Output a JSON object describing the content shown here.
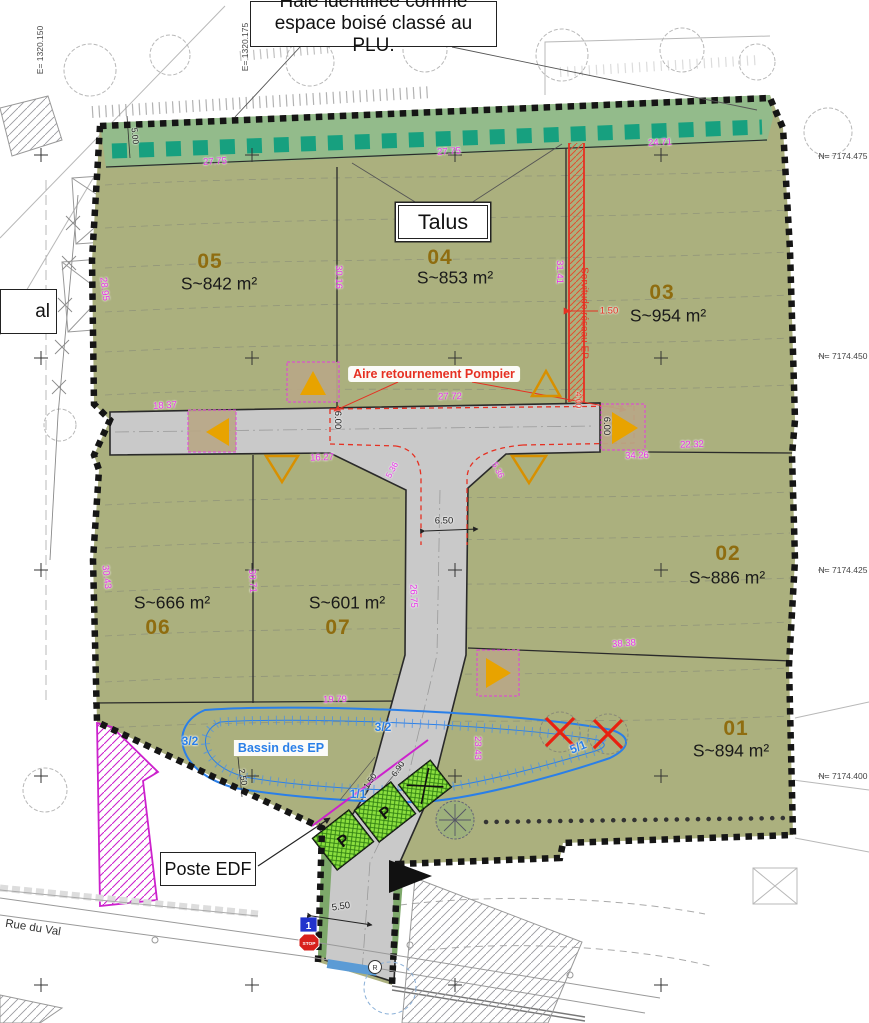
{
  "callouts": {
    "haie": "Haie identifiée comme espace boisé classé au PLU.",
    "talus": "Talus",
    "poste_edf": "Poste EDF",
    "aire_pompier": "Aire retournement Pompier",
    "bassin": "Bassin des EP",
    "rue": "Rue du Val",
    "servitude": "Servitude réseau EP",
    "cutoff": "al"
  },
  "signs": {
    "stop": "STOP",
    "lot_panel": "1",
    "manhole": "R"
  },
  "plots": [
    {
      "num": "05",
      "area": "S~842 m²",
      "nx": 210,
      "ny": 262,
      "ax": 219,
      "ay": 284
    },
    {
      "num": "04",
      "area": "S~853 m²",
      "nx": 440,
      "ny": 258,
      "ax": 455,
      "ay": 278
    },
    {
      "num": "03",
      "area": "S~954 m²",
      "nx": 662,
      "ny": 293,
      "ax": 668,
      "ay": 316
    },
    {
      "num": "02",
      "area": "S~886 m²",
      "nx": 728,
      "ny": 554,
      "ax": 727,
      "ay": 578
    },
    {
      "num": "01",
      "area": "S~894 m²",
      "nx": 736,
      "ny": 729,
      "ax": 731,
      "ay": 751
    },
    {
      "num": "06",
      "area": "S~666 m²",
      "nx": 158,
      "ny": 628,
      "ax": 172,
      "ay": 603
    },
    {
      "num": "07",
      "area": "S~601 m²",
      "nx": 338,
      "ny": 628,
      "ax": 347,
      "ay": 603
    }
  ],
  "coordinates": {
    "east": [
      {
        "t": "E= 1320.150",
        "x": 40,
        "y": 50
      },
      {
        "t": "E= 1320.175",
        "x": 245,
        "y": 47
      }
    ],
    "north": [
      {
        "t": "N= 7174.475",
        "x": 843,
        "y": 156
      },
      {
        "t": "N= 7174.450",
        "x": 843,
        "y": 356
      },
      {
        "t": "N= 7174.425",
        "x": 843,
        "y": 570
      },
      {
        "t": "N= 7174.400",
        "x": 843,
        "y": 776
      }
    ]
  },
  "labels": [
    {
      "t": "27.75",
      "x": 215,
      "y": 162,
      "r": -3,
      "c": "dim_magenta"
    },
    {
      "t": "27.75",
      "x": 449,
      "y": 152,
      "r": -3,
      "c": "dim_magenta"
    },
    {
      "t": "24.71",
      "x": 660,
      "y": 143,
      "r": -3,
      "c": "dim_magenta"
    },
    {
      "t": "30.16",
      "x": 338,
      "y": 277,
      "r": 90,
      "c": "dim_magenta"
    },
    {
      "t": "31.41",
      "x": 559,
      "y": 272,
      "r": 90,
      "c": "dim_magenta"
    },
    {
      "t": "28.95",
      "x": 104,
      "y": 289,
      "r": 83,
      "c": "dim_magenta"
    },
    {
      "t": "18.37",
      "x": 165,
      "y": 406,
      "r": -3,
      "c": "dim_magenta"
    },
    {
      "t": "16.27",
      "x": 322,
      "y": 458,
      "r": -2,
      "c": "dim_magenta"
    },
    {
      "t": "27.72",
      "x": 450,
      "y": 397,
      "r": -1,
      "c": "dim_magenta"
    },
    {
      "t": "34.26",
      "x": 637,
      "y": 456,
      "r": -2,
      "c": "dim_magenta"
    },
    {
      "t": "22.32",
      "x": 692,
      "y": 445,
      "r": -2,
      "c": "dim_magenta"
    },
    {
      "t": "38.38",
      "x": 624,
      "y": 644,
      "r": -4,
      "c": "dim_magenta"
    },
    {
      "t": "23.43",
      "x": 477,
      "y": 748,
      "r": 90,
      "c": "dim_magenta"
    },
    {
      "t": "30.43",
      "x": 106,
      "y": 577,
      "r": 83,
      "c": "dim_magenta"
    },
    {
      "t": "30.71",
      "x": 252,
      "y": 581,
      "r": 87,
      "c": "dim_magenta"
    },
    {
      "t": "26.75",
      "x": 413,
      "y": 596,
      "r": 88,
      "c": "dim_magenta"
    },
    {
      "t": "19.79",
      "x": 335,
      "y": 700,
      "r": -1,
      "c": "dim_magenta"
    },
    {
      "t": "5.36",
      "x": 392,
      "y": 470,
      "r": -62,
      "c": "dim_magenta",
      "s": 8.5
    },
    {
      "t": "5.36",
      "x": 498,
      "y": 470,
      "r": 62,
      "c": "dim_magenta",
      "s": 8.5
    },
    {
      "t": "6.00",
      "x": 337,
      "y": 420,
      "r": 90,
      "c": "ink"
    },
    {
      "t": "6.00",
      "x": 606,
      "y": 426,
      "r": 90,
      "c": "ink"
    },
    {
      "t": "6.50",
      "x": 444,
      "y": 521,
      "r": 0,
      "c": "ink"
    },
    {
      "t": "5.50",
      "x": 341,
      "y": 907,
      "r": -9,
      "c": "ink"
    },
    {
      "t": "5.00",
      "x": 135,
      "y": 136,
      "r": 85,
      "c": "ink",
      "s": 8.5
    },
    {
      "t": "2.50",
      "x": 243,
      "y": 777,
      "r": 80,
      "c": "ink",
      "s": 8.5
    },
    {
      "t": "1.50",
      "x": 370,
      "y": 781,
      "r": -55,
      "c": "ink",
      "s": 8.5
    },
    {
      "t": "6.90",
      "x": 398,
      "y": 769,
      "r": -55,
      "c": "ink",
      "s": 8.5
    },
    {
      "t": "1.50",
      "x": 609,
      "y": 311,
      "r": 0,
      "c": "red"
    },
    {
      "t": "4.00",
      "x": 578,
      "y": 400,
      "r": 90,
      "c": "red",
      "s": 8.5
    },
    {
      "t": "3/2",
      "x": 383,
      "y": 727,
      "r": 0,
      "c": "blue",
      "s": 12,
      "w": "bold",
      "n": "slope-label"
    },
    {
      "t": "5/1",
      "x": 578,
      "y": 747,
      "r": -22,
      "c": "blue",
      "s": 12,
      "w": "bold",
      "n": "slope-label"
    },
    {
      "t": "3/2",
      "x": 190,
      "y": 741,
      "r": 0,
      "c": "blue",
      "s": 12,
      "w": "bold",
      "n": "slope-label"
    },
    {
      "t": "1/1",
      "x": 358,
      "y": 794,
      "r": 0,
      "c": "blue",
      "s": 12,
      "w": "bold",
      "n": "slope-label"
    }
  ],
  "colors": {
    "plot_green": "#abb07e",
    "hedge_green": "#93bb8b",
    "hedge_teal": "#17a07f",
    "road_gray": "#c9c9c9",
    "dim_magenta": "#e832e8",
    "number_gold": "#8f6d10",
    "red": "#e63022",
    "blue": "#2a7fe8",
    "parking_green": "#8bdf3e",
    "marker_tan": "#b9a887",
    "triangle_orange": "#e8a300",
    "boundary_black": "#151515",
    "ink": "#222222",
    "coord": "#444444"
  }
}
